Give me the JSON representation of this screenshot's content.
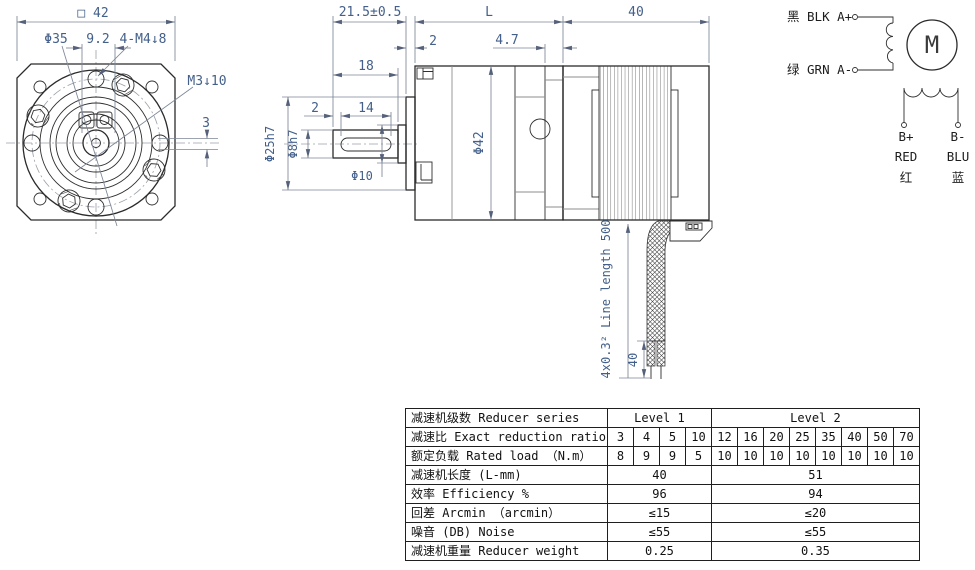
{
  "front_view": {
    "dim_square": "□ 42",
    "dim_bolt_circle_dia": "Φ35",
    "dim_hole_spacing": "9.2",
    "dim_mount_holes": "4-M4↓8",
    "dim_side_tap": "M3↓10",
    "dim_offset": "3"
  },
  "side_view": {
    "dim_shaft_length": "21.5±0.5",
    "dim_gearbox_length": "L",
    "dim_motor_length": "40",
    "dim_boss_protrusion": "2",
    "dim_rear_plate": "4.7",
    "dim_shaft_flat": "18",
    "dim_keyway_offset": "2",
    "dim_keyway_length": "14",
    "dim_pilot_dia": "Φ25h7",
    "dim_shaft_dia": "Φ8h7",
    "dim_collar_dia": "Φ10",
    "dim_body_dia": "Φ42",
    "cable_spec": "4x0.3² Line length 500",
    "dim_wire_strip": "40"
  },
  "wiring": {
    "lead_a_plus": "黑 BLK A+",
    "lead_a_minus": "绿 GRN A-",
    "motor_letter": "M",
    "lead_b_plus": [
      "B+",
      "RED",
      "红"
    ],
    "lead_b_minus": [
      "B-",
      "BLU",
      "蓝"
    ]
  },
  "table": {
    "series_label": "减速机级数 Reducer series",
    "level1": "Level 1",
    "level2": "Level 2",
    "ratio_label": "减速比 Exact reduction ratio",
    "ratios": [
      "3",
      "4",
      "5",
      "10",
      "12",
      "16",
      "20",
      "25",
      "35",
      "40",
      "50",
      "70"
    ],
    "load_label": "额定负载 Rated load （N.m）",
    "loads": [
      "8",
      "9",
      "9",
      "5",
      "10",
      "10",
      "10",
      "10",
      "10",
      "10",
      "10",
      "10"
    ],
    "length_label": "减速机长度 (L-mm)",
    "length_l1": "40",
    "length_l2": "51",
    "eff_label": "效率 Efficiency %",
    "eff_l1": "96",
    "eff_l2": "94",
    "backlash_label": "回差 Arcmin （arcmin）",
    "backlash_l1": "≤15",
    "backlash_l2": "≤20",
    "noise_label": "噪音 (DB) Noise",
    "noise_l1": "≤55",
    "noise_l2": "≤55",
    "weight_label": "减速机重量 Reducer weight",
    "weight_l1": "0.25",
    "weight_l2": "0.35"
  }
}
